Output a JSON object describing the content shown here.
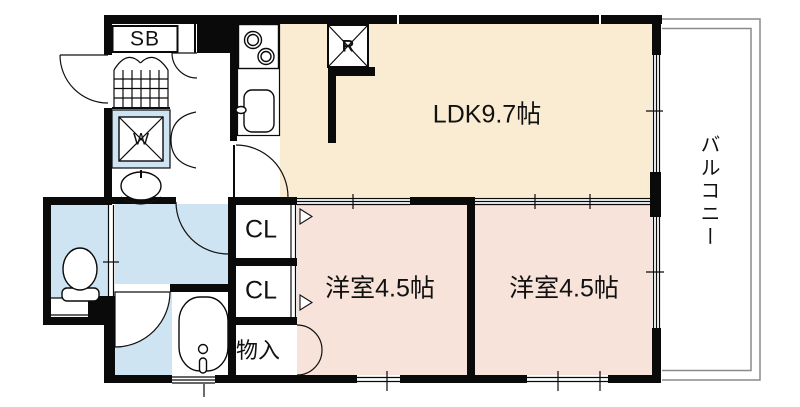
{
  "floorplan": {
    "rooms": {
      "ldk": {
        "label": "LDK9.7帖"
      },
      "western_room_1": {
        "label": "洋室4.5帖"
      },
      "western_room_2": {
        "label": "洋室4.5帖"
      },
      "balcony": {
        "label": "バルコニー"
      },
      "closet_upper": {
        "label": "CL"
      },
      "closet_lower": {
        "label": "CL"
      },
      "storage": {
        "label": "物入"
      }
    },
    "fixtures": {
      "shoe_box": {
        "label": "SB"
      },
      "washing_machine": {
        "label": "W"
      },
      "refrigerator": {
        "label": "R"
      }
    },
    "colors": {
      "ldk": "#faecd2",
      "bedroom": "#f8e3da",
      "water": "#cfe4f2",
      "wall": "#0a0a0a",
      "balcony_line": "#8a8a8a"
    }
  }
}
